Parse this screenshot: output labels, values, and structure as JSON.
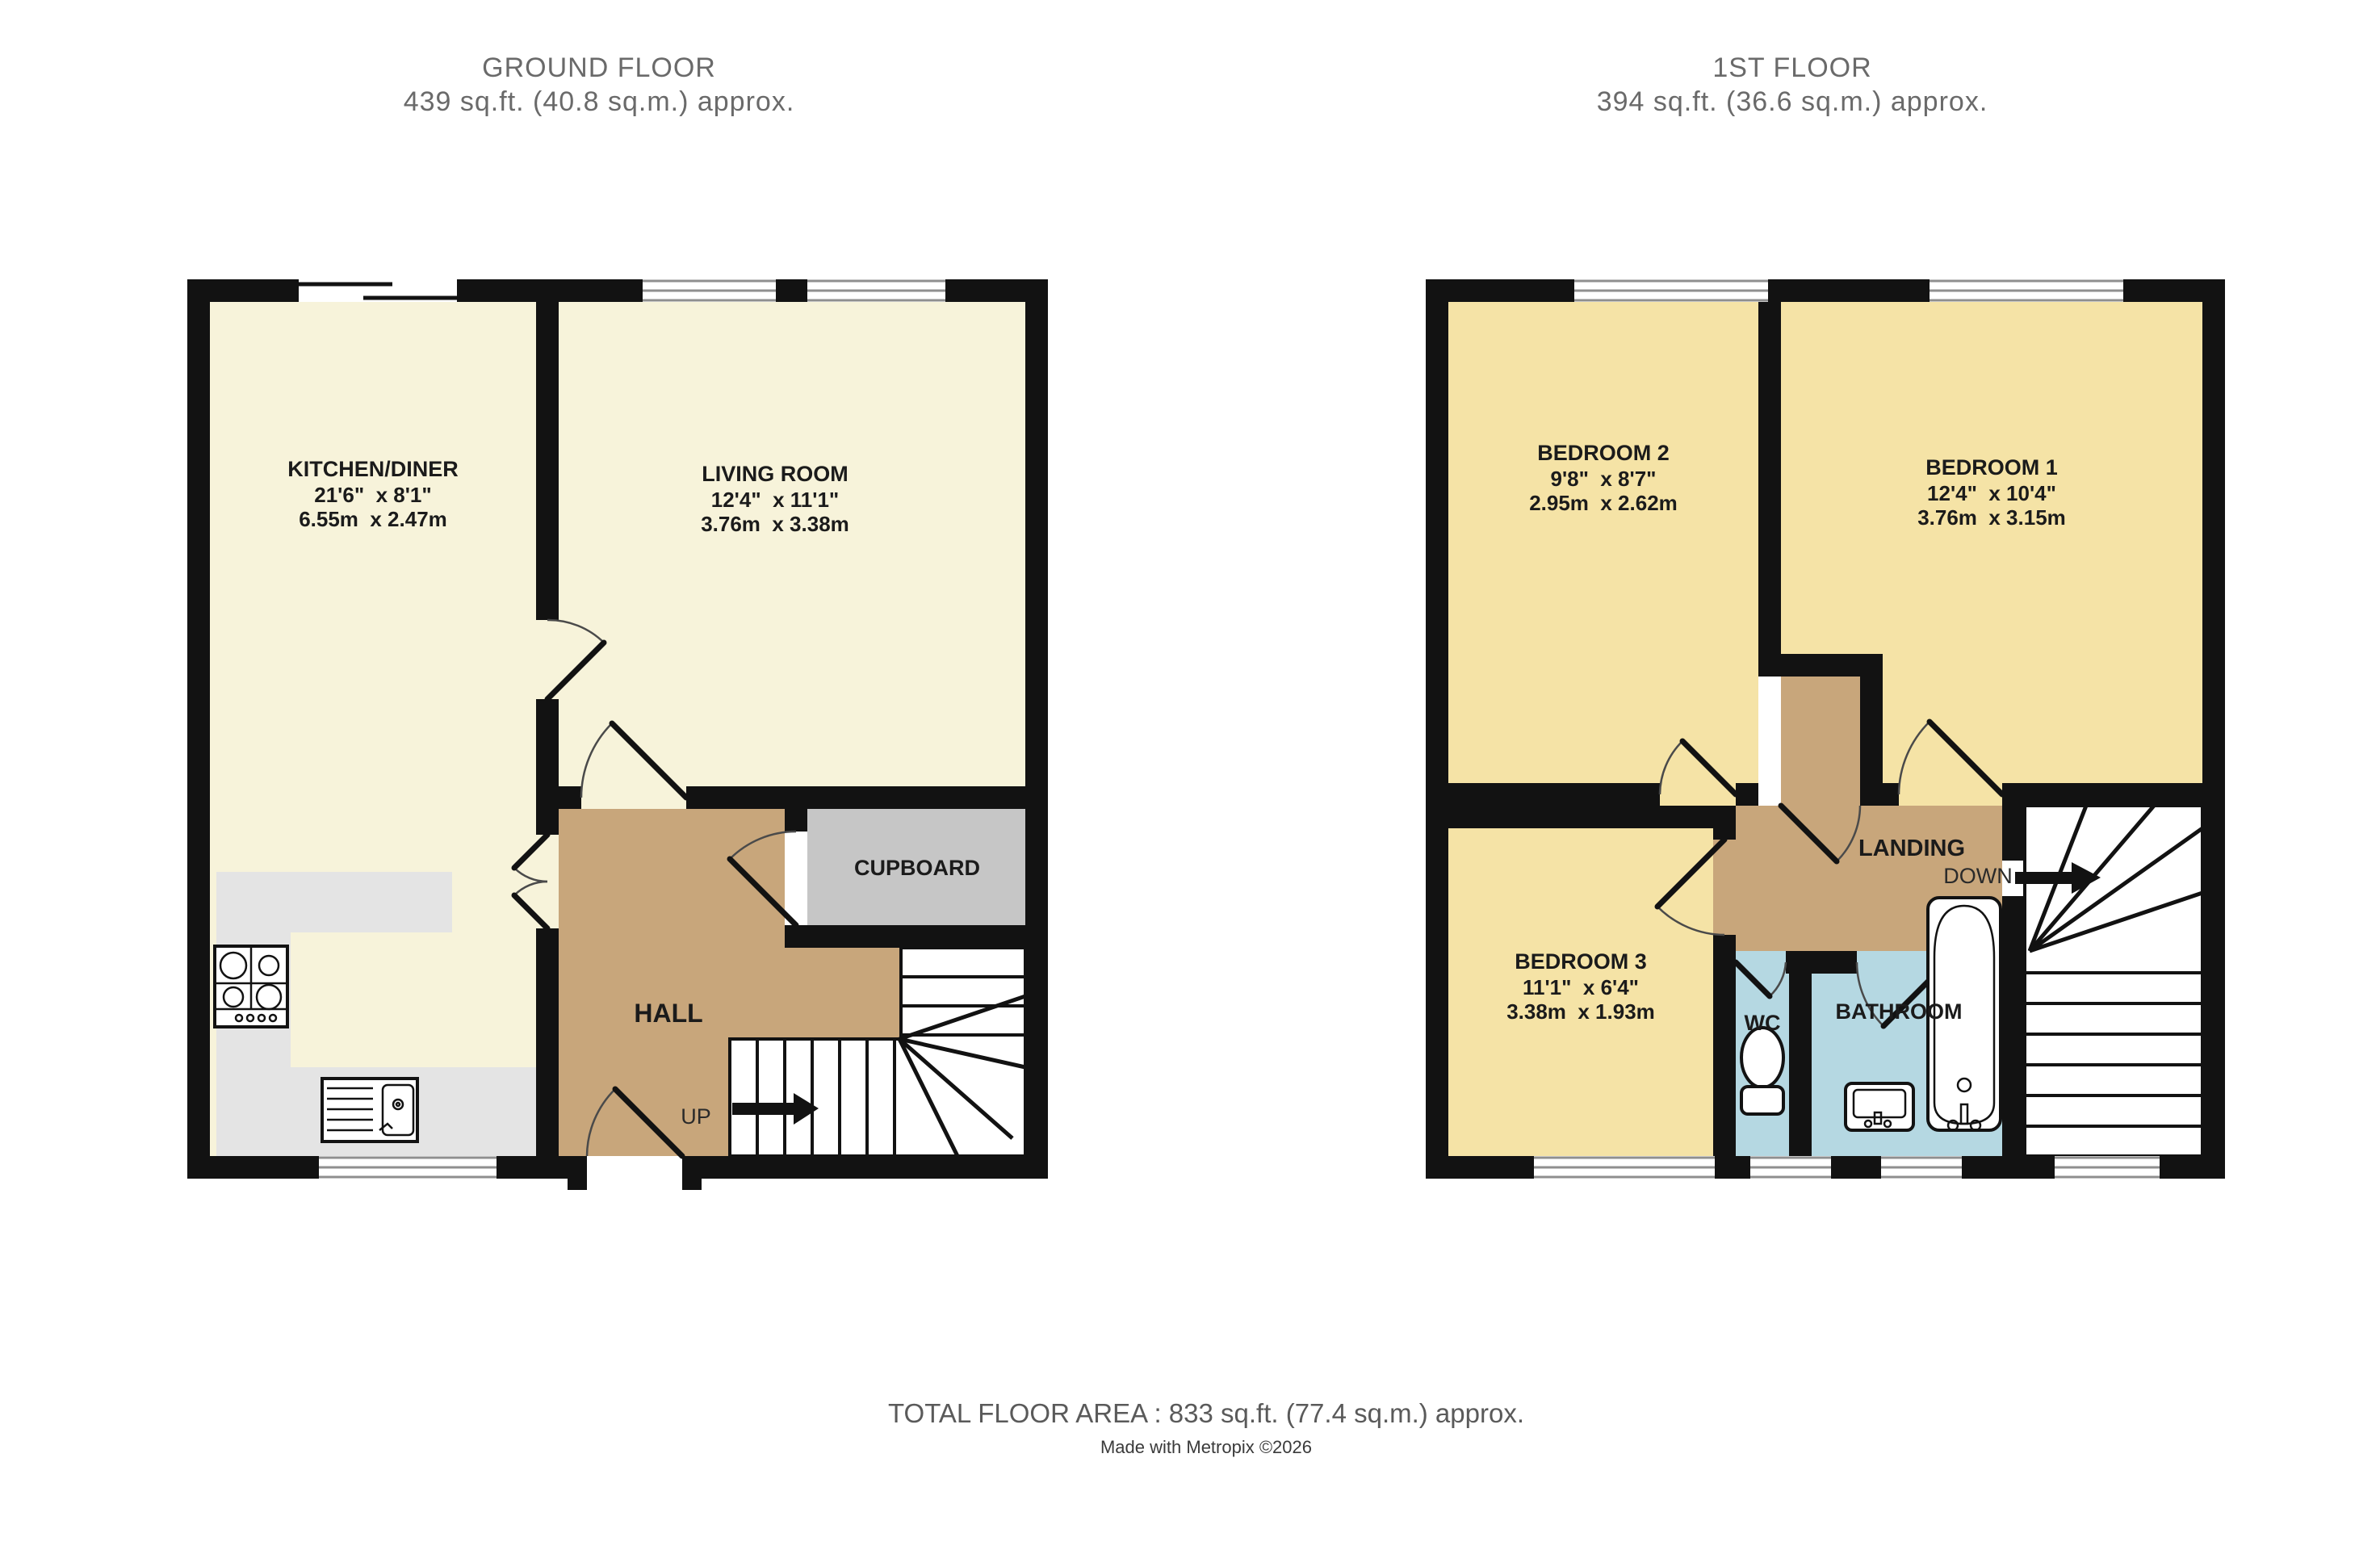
{
  "header": {
    "ground_floor_title": "GROUND FLOOR",
    "ground_floor_area": "439 sq.ft. (40.8 sq.m.) approx.",
    "first_floor_title": "1ST FLOOR",
    "first_floor_area": "394 sq.ft. (36.6 sq.m.) approx."
  },
  "footer": {
    "total_area": "TOTAL FLOOR AREA : 833 sq.ft. (77.4 sq.m.) approx.",
    "credit": "Made with Metropix ©2026"
  },
  "ground_floor": {
    "rooms": {
      "kitchen_diner": {
        "name": "KITCHEN/DINER",
        "size_imperial": "21'6\"  x 8'1\"",
        "size_metric": "6.55m  x 2.47m"
      },
      "living_room": {
        "name": "LIVING ROOM",
        "size_imperial": "12'4\"  x 11'1\"",
        "size_metric": "3.76m  x 3.38m"
      },
      "hall": {
        "name": "HALL"
      },
      "cupboard": {
        "name": "CUPBOARD"
      }
    },
    "stair_label": "UP"
  },
  "first_floor": {
    "rooms": {
      "bedroom1": {
        "name": "BEDROOM 1",
        "size_imperial": "12'4\"  x 10'4\"",
        "size_metric": "3.76m  x 3.15m"
      },
      "bedroom2": {
        "name": "BEDROOM 2",
        "size_imperial": "9'8\"  x 8'7\"",
        "size_metric": "2.95m  x 2.62m"
      },
      "bedroom3": {
        "name": "BEDROOM 3",
        "size_imperial": "11'1\"  x 6'4\"",
        "size_metric": "3.38m  x 1.93m"
      },
      "landing": {
        "name": "LANDING"
      },
      "wc": {
        "name": "WC"
      },
      "bathroom": {
        "name": "BATHROOM"
      }
    },
    "stair_label": "DOWN"
  },
  "colors": {
    "wall": "#121212",
    "room_cream": "#f7f3da",
    "room_yellow": "#f5e3a6",
    "hall_tan": "#c8a67b",
    "cupboard_gray": "#c6c6c6",
    "counter_gray": "#e4e4e4",
    "wet_room_blue": "#b5d8e2",
    "title_gray": "#6a6a6a"
  }
}
